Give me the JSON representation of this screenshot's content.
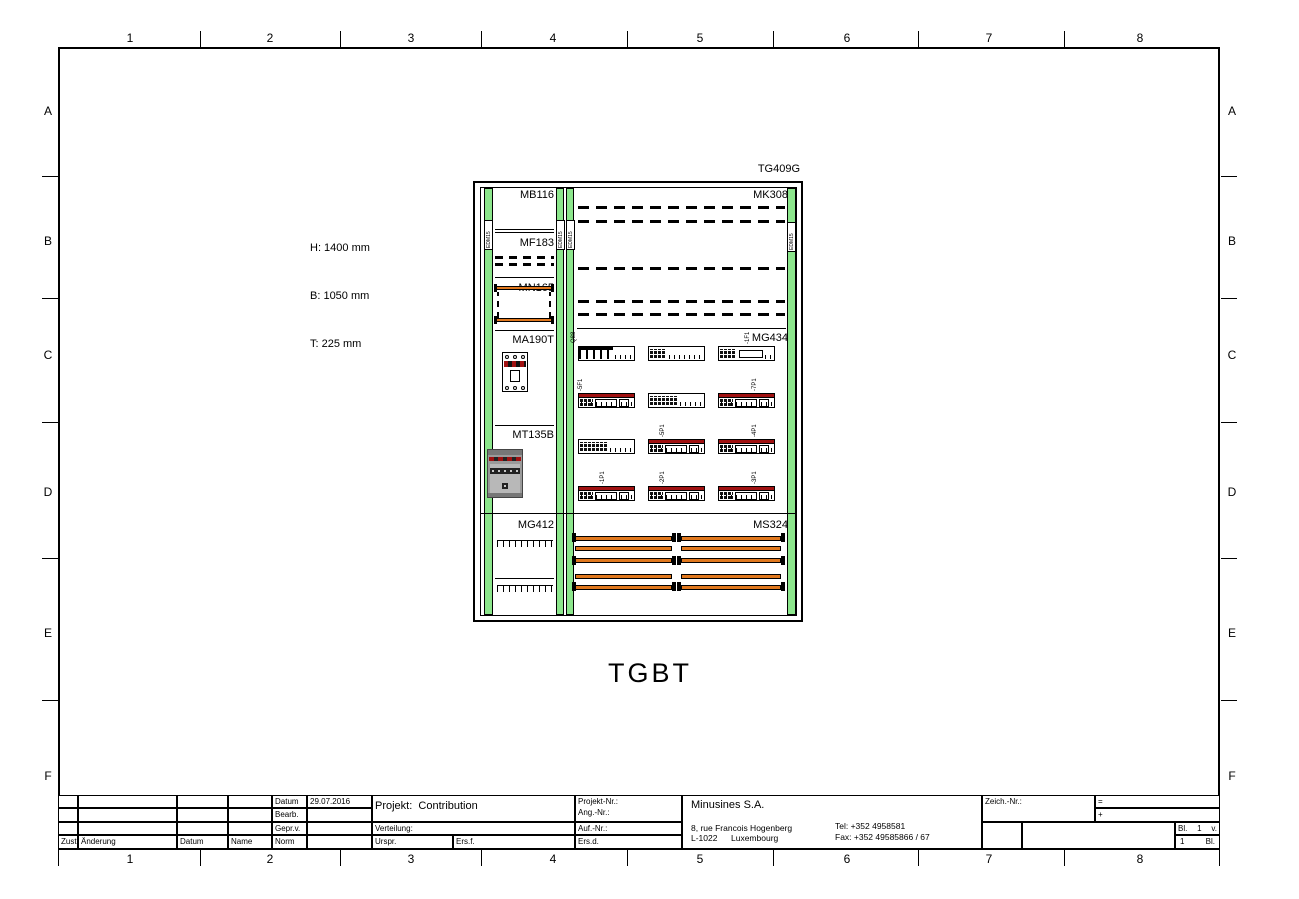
{
  "sheet": {
    "columns": [
      "1",
      "2",
      "3",
      "4",
      "5",
      "6",
      "7",
      "8"
    ],
    "rows": [
      "A",
      "B",
      "C",
      "D",
      "E",
      "F"
    ]
  },
  "cabinet": {
    "tag": "TG409G",
    "title": "TGBT",
    "dimensions": {
      "h": "H: 1400 mm",
      "b": "B: 1050 mm",
      "t": "T: 225 mm"
    },
    "sections": {
      "mb116": "MB116",
      "mk308": "MK308",
      "mf183": "MF183",
      "mn165": "MN165",
      "ma190t": "MA190T",
      "mg434": "MG434",
      "mt135b": "MT135B",
      "mg412": "MG412",
      "ms324": "MS324"
    },
    "rail_label": "EDM15",
    "device_tags": {
      "q88": "-Q88",
      "f1": "-1F1",
      "f5": "-5F1",
      "p7": "-7P1",
      "p5": "-5P1",
      "p4": "-4P1",
      "p1": "-1P1",
      "p2": "-2P1",
      "p3": "-3P1"
    },
    "colors": {
      "rail_green": "#8ce68c",
      "busbar_orange": "#e0781e",
      "stripe_red": "#a01111"
    }
  },
  "title_block": {
    "revision": {
      "zust": "Zust.",
      "aenderung": "Änderung",
      "datum": "Datum",
      "name": "Name"
    },
    "approval": {
      "datum_label": "Datum",
      "datum_value": "29.07.2016",
      "bearb": "Bearb.",
      "gepr": "Gepr.v.",
      "norm": "Norm"
    },
    "project": {
      "label": "Projekt:",
      "value": "Contribution",
      "verteilung": "Verteilung:",
      "urspr": "Urspr.",
      "ersf": "Ers.f."
    },
    "numbers": {
      "projekt_nr": "Projekt-Nr.:",
      "ang_nr": "Ang.-Nr.:",
      "auf_nr": "Auf.-Nr.:",
      "ersd": "Ers.d."
    },
    "company": {
      "name": "Minusines S.A.",
      "street": "8, rue Francois Hogenberg",
      "postal": "L-1022",
      "city": "Luxembourg",
      "tel": "Tel: +352 4958581",
      "fax": "Fax: +352 49585866 / 67"
    },
    "drawing_nr": {
      "zeich": "Zeich.-Nr.:",
      "eq": "=",
      "plus": "+",
      "bl": "Bl.",
      "sheet_no": "1",
      "v": "v.",
      "total": "1",
      "bl2": "Bl."
    }
  }
}
